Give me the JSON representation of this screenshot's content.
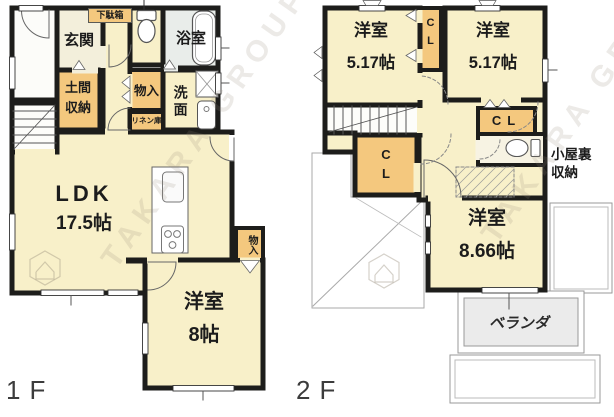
{
  "plan": {
    "type": "floor-plan",
    "watermark": "TAKARA GROUP",
    "f1": {
      "label": "1F",
      "getabako": "下駄箱",
      "genkan": "玄関",
      "bathroom": "浴室",
      "doma": "土間\n収納",
      "monoire": "物入",
      "senmen": "洗面",
      "linen": "リネン庫",
      "ldk": "LDK",
      "ldk_size": "17.5帖",
      "bedroom": "洋室",
      "bedroom_size": "8帖",
      "monoire2": "物入"
    },
    "f2": {
      "label": "2F",
      "bedroom_a": "洋室",
      "bedroom_a_size": "5.17帖",
      "bedroom_b": "洋室",
      "bedroom_b_size": "5.17帖",
      "closet_top": "C\nL",
      "closet_left": "C\nL",
      "closet_right": "CL",
      "attic": "小屋裏\n収納",
      "bedroom_c": "洋室",
      "bedroom_c_size": "8.66帖",
      "veranda": "ベランダ"
    },
    "colors": {
      "wall": "#1d1d1b",
      "room": "#f8f0c9",
      "closet": "#f4c87e",
      "bath": "#e9edea",
      "entry": "#f3efdb",
      "veranda": "#ebebeb"
    }
  }
}
